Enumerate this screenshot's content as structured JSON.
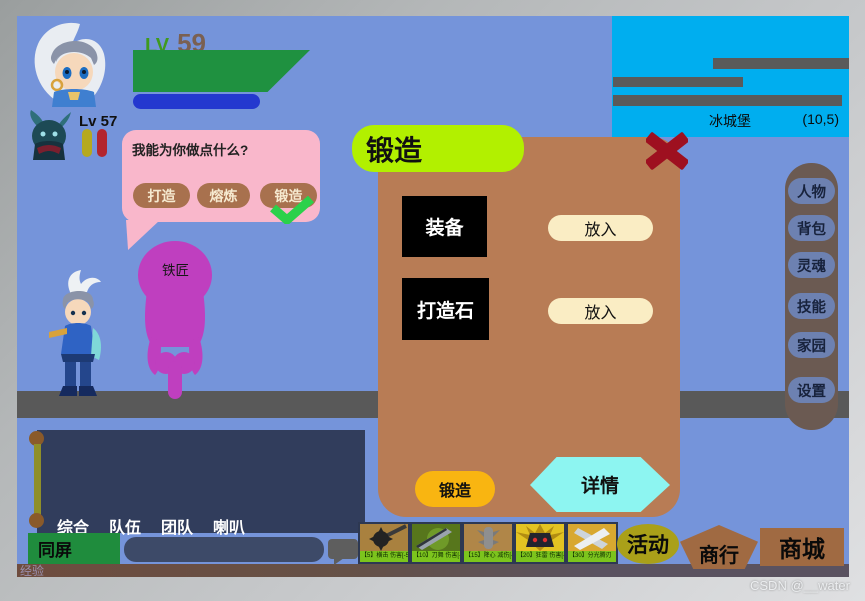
{
  "window": {
    "watermark": "CSDN @__water"
  },
  "hud": {
    "lv_label": "LV",
    "player_level": "59",
    "partner_level_label": "Lv 57"
  },
  "minimap": {
    "location_name": "冰城堡",
    "coordinates": "(10,5)"
  },
  "npc_bubble": {
    "question": "我能为你做点什么?",
    "options": [
      "打造",
      "熔炼",
      "锻造"
    ]
  },
  "npc": {
    "name": "铁匠"
  },
  "forge_panel": {
    "title": "锻造",
    "slot1_label": "装备",
    "slot1_action": "放入",
    "slot2_label": "打造石",
    "slot2_action": "放入",
    "confirm_label": "锻造",
    "details_label": "详情"
  },
  "side_menu": {
    "items": [
      "人物",
      "背包",
      "灵魂",
      "技能",
      "家园",
      "设置"
    ]
  },
  "chat": {
    "tabs": [
      "综合",
      "队伍",
      "团队",
      "喇叭"
    ],
    "same_screen": "同屏",
    "input_value": "",
    "exp_label": "经验"
  },
  "hotbar": {
    "items": [
      {
        "label": "【5】横击 伤害[-5]"
      },
      {
        "label": "【10】刀舞 伤害[-3]"
      },
      {
        "label": "【15】降心 减伤[-10]"
      },
      {
        "label": "【20】狂雷 伤害[-90]"
      },
      {
        "label": "【30】分光腾刃"
      }
    ]
  },
  "corner_buttons": {
    "activity": "活动",
    "trade_house": "商行",
    "mall": "商城"
  },
  "colors": {
    "background_blue": "#7594da",
    "panel_brown": "#b87c55",
    "title_green": "#b2f000",
    "minimap_blue": "#00aeef",
    "accent_yellow": "#f9b511",
    "detail_cyan": "#8df5f1",
    "close_red": "#9e1020",
    "npc_magenta": "#bf3fbf",
    "chat_navy": "#313d5c",
    "same_screen_green": "#1f8c3d",
    "hotbar_label_green": "#7cc41d",
    "activity_olive": "#aaa019",
    "shop_brown": "#a06a42"
  }
}
